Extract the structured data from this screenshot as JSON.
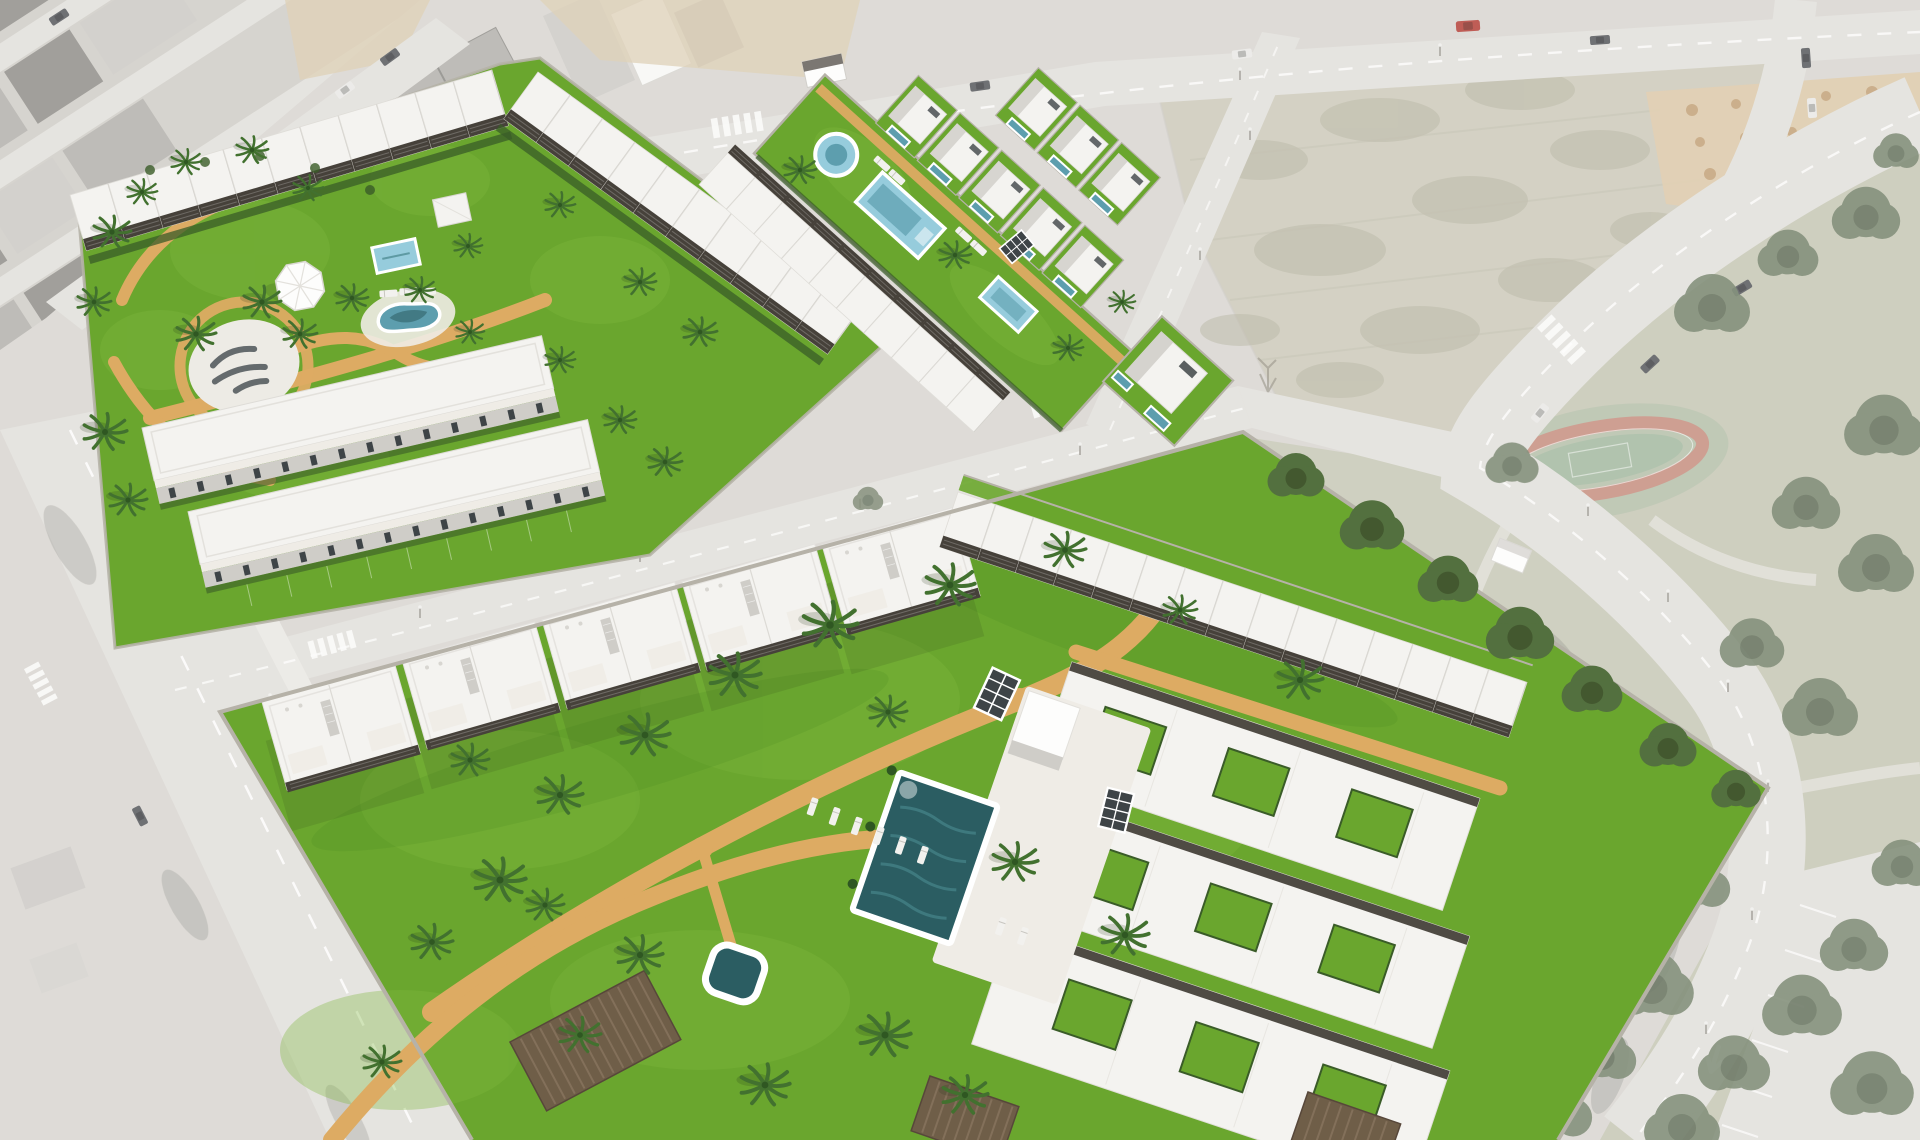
{
  "meta": {
    "description": "Aerial 3D architectural render of a new coastal residential development: white townhouse and apartment parcels with green lawns, pools and palm trees shown in saturated color over a desaturated aerial photo of the existing town, vacant lots, roads and a public park"
  },
  "palette": {
    "base": "#d8d5d0",
    "road": "#e1dfda",
    "road_edge": "#c9c6c0",
    "marking": "#ffffff",
    "town_base": "#cfccc6",
    "roof_dark": "#8f8d88",
    "roof_mid": "#b2b0ab",
    "roof_light": "#cbc9c4",
    "sand": "#d9c9ab",
    "field": "#ccc9b9",
    "scrub": "#b2af9c",
    "dirt": "#dcc8a6",
    "mound": "#c2a077",
    "park": "#c5c6b3",
    "track": "#c58d7e",
    "court": "#a3b89f",
    "tree": "#6f7d65",
    "tree_dark": "#56644d",
    "tree_vivid": "#4f6b3d",
    "tree_gold": "#c2a75e",
    "lawn": "#6aa62e",
    "lawn_light": "#7db63d",
    "lawn_dark": "#4d8b23",
    "hedge": "#3a5c28",
    "path": "#ddab63",
    "path_light": "#e6bc79",
    "pool_dark": "#2b5d62",
    "pool_ripple": "#47868b",
    "pool_light": "#96ccdc",
    "pool_mid": "#5d9eae",
    "deck": "#efece6",
    "white_roof": "#f4f3f0",
    "white_wall": "#fdfdfc",
    "shade_wall": "#cfcdc8",
    "glass": "#3e4447",
    "pergola": "#46413a",
    "timber": "#6f5e48",
    "wall": "#b6b2a8",
    "trunk": "#9b8669",
    "palm": "#42712f",
    "palm_dark": "#2f5722",
    "lounger": "#f2f1ee",
    "car_red": "#b33f36",
    "car_dark": "#54565a",
    "car_white": "#e9e8e5",
    "shadow": "#243318",
    "ground_shadow": "#6b6b64",
    "plaza": "#edebe5",
    "logo_ink": "#4e5559",
    "wash": "#ffffff"
  },
  "scene": {
    "type": "aerial architectural render",
    "parcels": [
      {
        "id": "parcel-a",
        "label": "northwest community",
        "features": [
          "townhouse row north",
          "townhouse row east",
          "two low apartment blocks",
          "circular plaza with illegible ground lettering",
          "kidney pool",
          "small square pool",
          "octagonal shade canopy",
          "white pavilion",
          "tan gravel paths",
          "palm trees"
        ]
      },
      {
        "id": "parcel-b",
        "label": "central townhouse strip",
        "features": [
          "communal green strip",
          "round splash pool",
          "rectangular pool",
          "small rectangular pool",
          "townhouse row",
          "villa rows with private pools",
          "detached corner villa"
        ]
      },
      {
        "id": "parcel-d",
        "label": "south community",
        "features": [
          "five apartment blocks",
          "terraced row with dark pergolas",
          "east apartment cluster with courtyards",
          "large lawn",
          "main pool with white coping",
          "pool deck",
          "jacuzzi pool",
          "sun loungers",
          "white cube kiosk",
          "glass trellis panels",
          "timber carports",
          "curving tan paths",
          "palm trees"
        ]
      }
    ],
    "environment": [
      "existing town blocks (faded)",
      "vacant scrub field",
      "sandy lot with spoil mounds",
      "public park with pine trees",
      "oval running track with court",
      "road network with lane markings",
      "crosswalks",
      "cars",
      "street lamps"
    ],
    "pools_total": 9,
    "render_style": "new parcels saturated, surroundings washed out"
  }
}
